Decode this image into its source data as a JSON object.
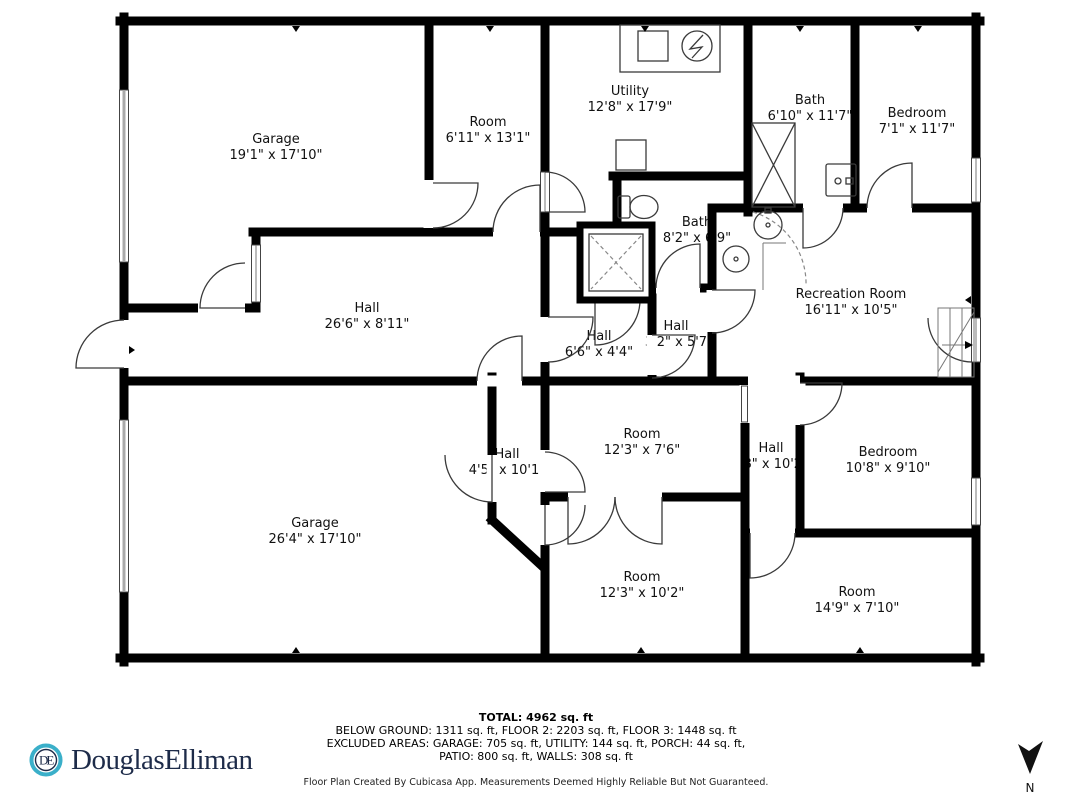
{
  "plan": {
    "rooms": [
      {
        "name": "Garage",
        "dims": "19'1\" x 17'10\""
      },
      {
        "name": "Room",
        "dims": "6'11\" x 13'1\""
      },
      {
        "name": "Utility",
        "dims": "12'8\" x 17'9\""
      },
      {
        "name": "Bath",
        "dims": "6'10\" x 11'7\""
      },
      {
        "name": "Bedroom",
        "dims": "7'1\" x 11'7\""
      },
      {
        "name": "Bath",
        "dims": "8'2\" x 6'9\""
      },
      {
        "name": "Hall",
        "dims": "26'6\" x 8'11\""
      },
      {
        "name": "Hall",
        "dims": "6'6\" x 4'4\""
      },
      {
        "name": "Hall",
        "dims": "3'2\" x 5'7"
      },
      {
        "name": "Recreation Room",
        "dims": "16'11\" x 10'5\""
      },
      {
        "name": "Hall",
        "dims": "4'5\" x 10'1\""
      },
      {
        "name": "Room",
        "dims": "12'3\" x 7'6\""
      },
      {
        "name": "Hall",
        "dims": "'8\" x 10'2"
      },
      {
        "name": "Bedroom",
        "dims": "10'8\" x 9'10\""
      },
      {
        "name": "Garage",
        "dims": "26'4\" x 17'10\""
      },
      {
        "name": "Room",
        "dims": "12'3\" x 10'2\""
      },
      {
        "name": "Room",
        "dims": "14'9\" x 7'10\""
      }
    ]
  },
  "footer": {
    "total": "TOTAL: 4962 sq. ft",
    "floors": "BELOW GROUND: 1311 sq. ft, FLOOR 2: 2203 sq. ft, FLOOR 3: 1448 sq. ft",
    "excluded": "EXCLUDED AREAS: GARAGE: 705 sq. ft, UTILITY: 144 sq. ft, PORCH: 44 sq. ft,",
    "excluded2": "PATIO: 800 sq. ft, WALLS: 308 sq. ft",
    "credit": "Floor Plan Created By Cubicasa App. Measurements Deemed Highly Reliable But Not Guaranteed."
  },
  "branding": {
    "wordmark": "DouglasElliman",
    "monogram": "DE",
    "teal": "#3AAFC9",
    "navy": "#1D2B49"
  },
  "compass": {
    "label": "N"
  }
}
